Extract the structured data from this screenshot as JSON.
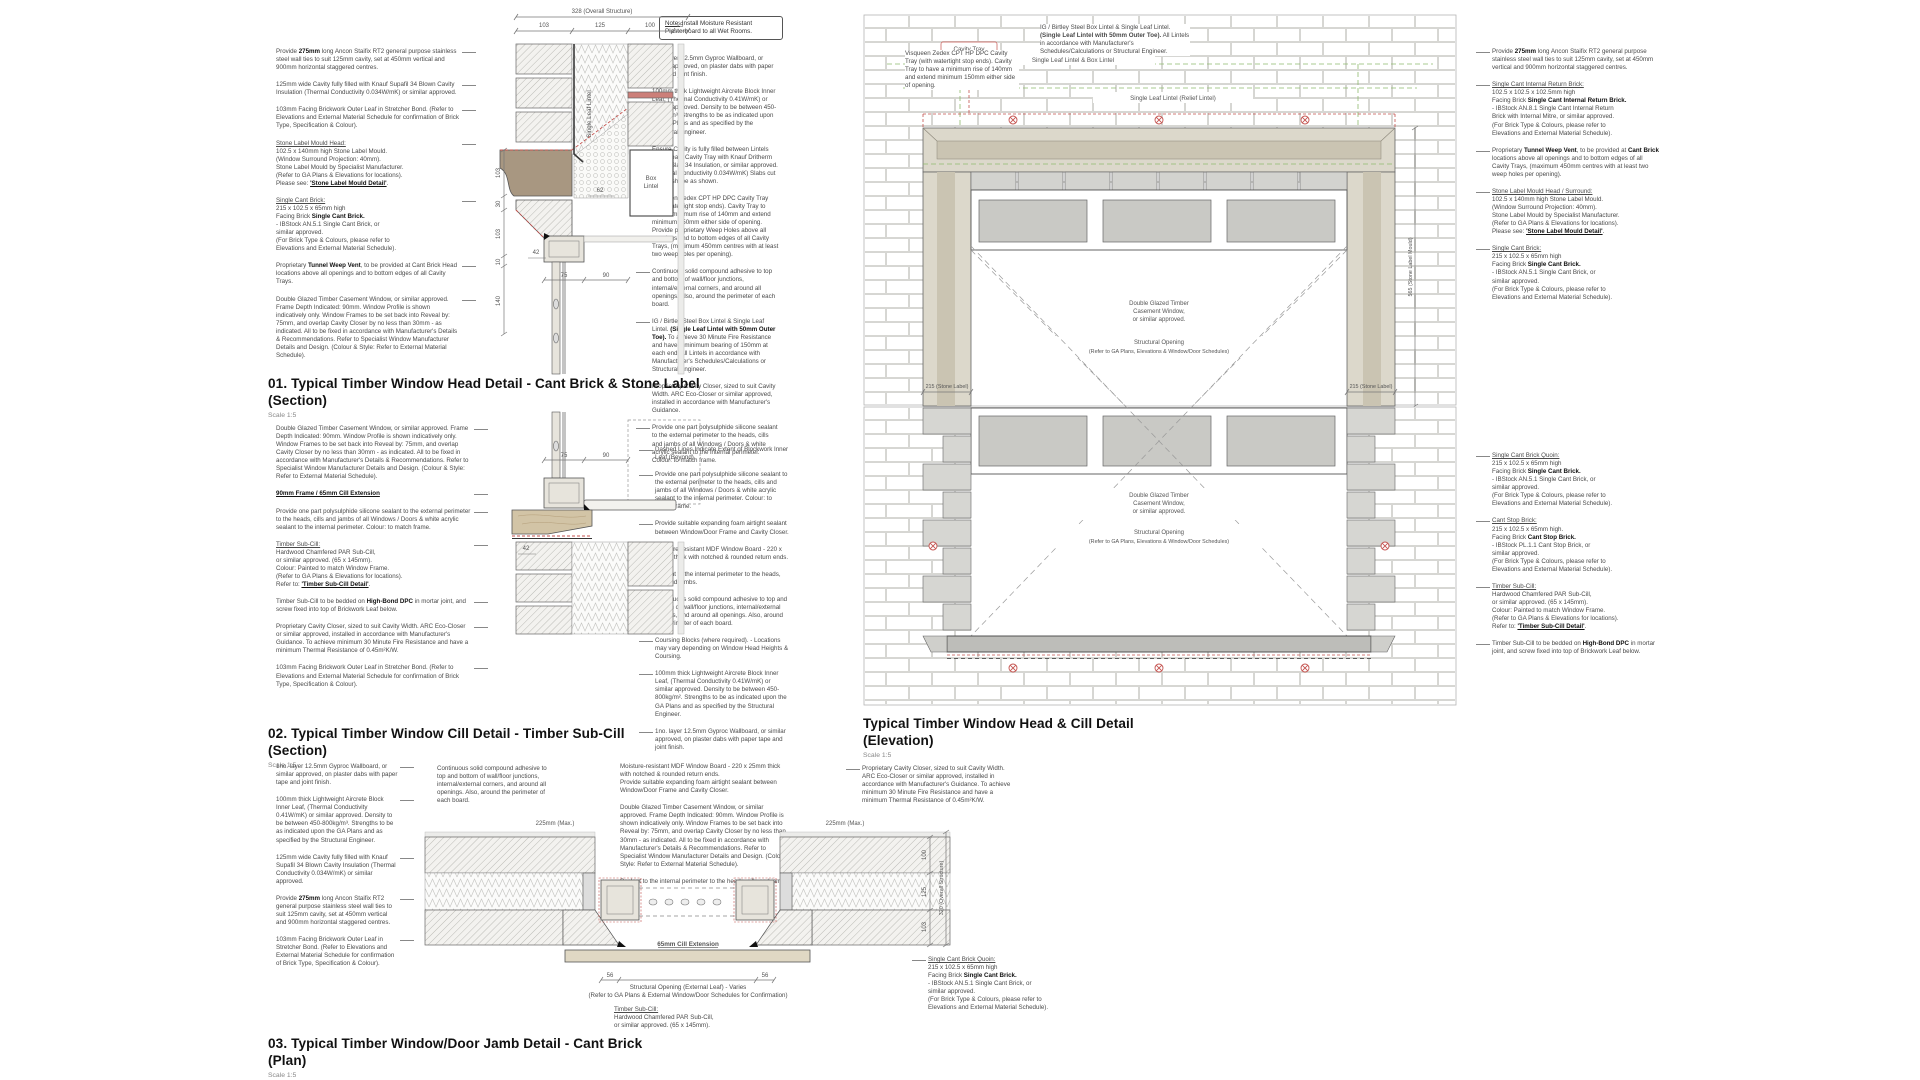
{
  "palette": {
    "green": "#8fba6e",
    "red": "#c4524e",
    "stone": "#a89781",
    "brick_joint": "#cdcdc9",
    "ink": "#444444"
  },
  "note_box": {
    "text": "__Note:__ Install Moisture Resistant Plasterboard to all Wet Rooms."
  },
  "titles": {
    "d1": {
      "line1": "01. Typical Timber Window Head Detail - Cant Brick & Stone Label",
      "line2": "(Section)",
      "scale": "Scale 1:5"
    },
    "d2": {
      "line1": "02. Typical Timber Window Cill Detail - Timber Sub-Cill",
      "line2": "(Section)",
      "scale": "Scale 1:5"
    },
    "d3": {
      "line1": "03. Typical Timber Window/Door Jamb Detail - Cant Brick",
      "line2": "(Plan)",
      "scale": "Scale 1:5"
    },
    "elev": {
      "line1": "Typical Timber Window Head & Cill Detail",
      "line2": "(Elevation)",
      "scale": "Scale 1:5"
    }
  },
  "d1": {
    "left_notes": [
      "Provide **275mm** long Ancon Staifix RT2 general purpose stainless steel wall ties to suit 125mm cavity, set at 450mm vertical and 900mm horizontal staggered centres.",
      "125mm wide Cavity fully filled with Knauf Supafil 34 Blown Cavity Insulation (Thermal Conductivity 0.034W/mK) or similar approved.",
      "103mm Facing Brickwork Outer Leaf in Stretcher Bond. (Refer to Elevations and External Material Schedule for confirmation of Brick Type, Specification & Colour).",
      "__Stone Label Mould Head:__\n102.5 x 140mm high Stone Label Mould.\n(Window Surround Projection: 40mm).\nStone Label Mould by Specialist Manufacturer.\n(Refer to GA Plans & Elevations for locations).\nPlease see: **__'Stone Label Mould Detail'__**.",
      "__Single Cant Brick:__\n215 x 102.5 x 65mm high\nFacing Brick **Single Cant Brick.**\n- IBStock AN.5.1 Single Cant Brick, or\nsimilar approved.\n(For Brick Type & Colours, please refer to\nElevations and External Material Schedule).",
      "Proprietary **Tunnel Weep Vent**, to be provided at Cant Brick Head locations above all openings and to bottom edges of all Cavity Trays.",
      "Double Glazed Timber Casement Window, or similar approved. Frame Depth Indicated: 90mm. Window Profile is shown indicatively only. Window Frames to be set back into Reveal by: 75mm, and overlap Cavity Closer by no less than 30mm - as indicated. All to be fixed in accordance with Manufacturer's Details & Recommendations. Refer to Specialist Window Manufacturer Details and Design. (Colour & Style: Refer to External Material Schedule)."
    ],
    "right_notes": [
      "1no. layer 12.5mm Gyproc Wallboard, or similar approved, on plaster dabs with paper tape and joint finish.",
      "100mm thick Lightweight Aircrete Block Inner Leaf, (Thermal Conductivity 0.41W/mK) or similar approved. Density to be between 450-800kg/m³. Strengths to be as indicated upon the GA Plans and as specified by the Structural Engineer.",
      "Ensure Cavity is fully filled between Lintels underneath Cavity Tray with Knauf Dritherm Cavity Slab 34 Insulation, or similar approved. (Thermal Conductivity 0.034W/mK) Slabs cut to size/shape as shown.",
      "Visqueen Zedex CPT HP DPC Cavity Tray (with watertight stop ends). Cavity Tray to have a minimum rise of 140mm and extend minimum 150mm either side of opening. Provide proprietary Weep Holes above all openings and to bottom edges of all Cavity Trays, (maximum 450mm centres with at least two weep holes per opening).",
      "Continuous solid compound adhesive to top and bottom of wall/floor junctions, internal/external corners, and around all openings. Also, around the perimeter of each board.",
      "IG / Birtley Steel Box Lintel & Single Leaf Lintel. **(Single Leaf Lintel with 50mm Outer Toe).** To achieve 30 Minute Fire Resistance and have a minimum bearing of 150mm at each end. All Lintels in accordance with Manufacturer's Schedules/Calculations or Structural Engineer.",
      "Proprietary Cavity Closer, sized to suit Cavity Width. ARC Eco-Closer or similar approved, installed in accordance with Manufacturer's Guidance.",
      "Provide one part polysulphide silicone sealant to the external perimeter to the heads, cills and jambs of all Windows / Doors & white acrylic sealant to the internal perimeter. Colour: to match frame."
    ],
    "dims": {
      "overall": "328 (Overall Structure)",
      "seg1": "103",
      "seg2": "125",
      "seg3": "100",
      "seg4": "25",
      "side1": "103",
      "side2": "30",
      "side3": "103",
      "side4": "10",
      "side5": "140",
      "bot1": "75",
      "bot2": "90",
      "inner1": "62",
      "inner2": "42"
    },
    "labels": {
      "single_leaf_lintel": "Single Leaf Lintel",
      "box_lintel_1": "Box",
      "box_lintel_2": "Lintel"
    }
  },
  "d2": {
    "left_notes": [
      "Double Glazed Timber Casement Window, or similar approved. Frame Depth Indicated: 90mm. Window Profile is shown indicatively only. Window Frames to be set back into Reveal by: 75mm, and overlap Cavity Closer by no less than 30mm - as indicated. All to be fixed in accordance with Manufacturer's Details & Recommendations. Refer to Specialist Window Manufacturer Details and Design. (Colour & Style: Refer to External Material Schedule).",
      "**__90mm Frame / 65mm Cill Extension__**",
      "Provide one part polysulphide silicone sealant to the external perimeter to the heads, cills and jambs of all Windows / Doors & white acrylic sealant to the internal perimeter. Colour: to match frame.",
      "__Timber Sub-Cill:__\nHardwood Chamfered PAR Sub-Cill,\nor similar approved. (65 x 145mm).\nColour: Painted to match Window Frame.\n(Refer to GA Plans & Elevations for locations).\nRefer to: **__'Timber Sub-Cill Detail'__**.",
      "Timber Sub-Cill to be bedded on **High-Bond DPC** in mortar joint, and screw fixed into top of Brickwork Leaf below.",
      "Proprietary Cavity Closer, sized to suit Cavity Width. ARC Eco-Closer or similar approved, installed in accordance with Manufacturer's Guidance. To achieve minimum 30 Minute Fire Resistance and have a minimum Thermal Resistance of 0.45m²K/W.",
      "103mm Facing Brickwork Outer Leaf in Stretcher Bond. (Refer to Elevations and External Material Schedule for confirmation of Brick Type, Specification & Colour)."
    ],
    "right_notes": [
      "Dashed Lines Indicate Extent of Blockwork Inner Leaf (Beyond).",
      "Provide one part polysulphide silicone sealant to the external perimeter to the heads, cills and jambs of all Windows / Doors & white acrylic sealant to the internal perimeter. Colour: to match frame.",
      "Provide suitable expanding foam airtight sealant between Window/Door Frame and Cavity Closer.",
      "Moisture-resistant MDF Window Board - 220 x 25mm thick with notched & rounded return ends.",
      "Sealant to the internal perimeter to the heads, cills and jambs.",
      "Continuous solid compound adhesive to top and bottom of wall/floor junctions, internal/external corners, and around all openings. Also, around the perimeter of each board.",
      "Coursing Blocks (where required). - Locations may vary depending on Window Head Heights & Coursing.",
      "100mm thick Lightweight Aircrete Block Inner Leaf, (Thermal Conductivity 0.41W/mK) or similar approved. Density to be between 450-800kg/m². Strengths to be as indicated upon the GA Plans and as specified by the Structural Engineer.",
      "1no. layer 12.5mm Gyproc Wallboard, or similar approved, on plaster dabs with paper tape and joint finish."
    ],
    "dims": {
      "d75": "75",
      "d90": "90",
      "d42": "42"
    }
  },
  "d3": {
    "left_notes": [
      "1no. layer 12.5mm Gyproc Wallboard, or similar approved, on plaster dabs with paper tape and joint finish.",
      "100mm thick Lightweight Aircrete Block Inner Leaf, (Thermal Conductivity 0.41W/mK) or similar approved. Density to be between 450-800kg/m³. Strengths to be as indicated upon the GA Plans and as specified by the Structural Engineer.",
      "125mm wide Cavity fully filled with Knauf Supafil 34 Blown Cavity Insulation (Thermal Conductivity 0.034W/mK) or similar approved.",
      "Provide **275mm** long Ancon Staifix RT2 general purpose stainless steel wall ties to suit 125mm cavity, set at 450mm vertical and 900mm horizontal staggered centres.",
      "103mm Facing Brickwork Outer Leaf in Stretcher Bond. (Refer to Elevations and External Material Schedule for confirmation of Brick Type, Specification & Colour)."
    ],
    "mid_notes": [
      "Continuous solid compound adhesive to top and bottom of wall/floor junctions, internal/external corners, and around all openings. Also, around the perimeter of each board."
    ],
    "top_notes": [
      "Moisture-resistant MDF Window Board - 220 x 25mm thick with notched & rounded return ends.\nProvide suitable expanding foam airtight sealant between Window/Door Frame and Cavity Closer.",
      "Double Glazed Timber Casement Window, or similar approved. Frame Depth Indicated: 90mm. Window Profile is shown indicatively only. Window Frames to be set back into Reveal by: 75mm, and overlap Cavity Closer by no less than 30mm - as indicated. All to be fixed in accordance with Manufacturer's Details & Recommendations. Refer to Specialist Window Manufacturer Details and Design. (Colour & Style: Refer to External Material Schedule).",
      "Sealant to the internal perimeter to the heads, cills and jambs."
    ],
    "right_notes": [
      "Proprietary Cavity Closer, sized to suit Cavity Width. ARC Eco-Closer or similar approved, installed in accordance with Manufacturer's Guidance. To achieve minimum 30 Minute Fire Resistance and have a minimum Thermal Resistance of 0.45m²K/W."
    ],
    "quoin_note": [
      "__Single Cant Brick Quoin:__\n215 x 102.5 x 65mm high\nFacing Brick **Single Cant Brick.**\n- IBStock AN.5.1 Single Cant Brick, or\nsimilar approved.\n(For Brick Type & Colours, please refer to\nElevations and External Material Schedule)."
    ],
    "cill_label": "65mm Cill Extension",
    "bottom_center": "Structural Opening (External Leaf) - Varies\n(Refer to GA Plans & External Window/Door Schedules for Confirmation)",
    "subcill_note": "__Timber Sub-Cill:__\nHardwood Chamfered PAR Sub-Cill,\nor similar approved. (65 x 145mm).",
    "dims": {
      "max_left": "225mm (Max.)",
      "max_right": "225mm (Max.)",
      "d56l": "56",
      "d56r": "56",
      "v1": "100",
      "v2": "125",
      "v3": "103",
      "overall": "320 (Overall Structure)"
    }
  },
  "elev": {
    "top_notes": {
      "visqueen": "Visqueen Zedex CPT HP DPC Cavity Tray (with watertight stop ends). Cavity Tray to have a minimum rise of 140mm and extend minimum 150mm either side of opening.",
      "lintel": "IG / Birtley Steel Box Lintel & Single Leaf Lintel. **(Single Leaf Lintel with 50mm Outer Toe).** All Lintels in accordance with Manufacturer's Schedules/Calculations or Structural Engineer."
    },
    "labels": {
      "cavity_tray": "Cavity Tray",
      "lintel_a": "Single Leaf Lintel & Box Lintel",
      "lintel_b": "Single Leaf Lintel (Relief Lintel)"
    },
    "center": {
      "l1": "Double Glazed Timber",
      "l2": "Casement Window,",
      "l3": "or similar approved.",
      "l4": "Structural Opening",
      "l5": "(Refer to GA Plans, Elevations & Window/Door Schedules)"
    },
    "dims": {
      "stone_l": "215 (Stone Label)",
      "stone_r": "215 (Stone Label)",
      "mould": "565 (Stone Label Mould)"
    },
    "right_notes_head": [
      "Provide **275mm** long Ancon Staifix RT2 general purpose stainless steel wall ties to suit 125mm cavity, set at 450mm vertical and 900mm horizontal staggered centres.",
      "__Single Cant Internal Return Brick:__\n102.5 x 102.5 x 102.5mm high\nFacing Brick **Single Cant Internal Return Brick.**\n- IBStock AN.8.1 Single Cant Internal Return\nBrick with Internal Mitre, or similar approved.\n(For Brick Type & Colours, please refer to\nElevations and External Material Schedule).",
      "Proprietary **Tunnel Weep Vent**, to be provided at **Cant Brick** locations above all openings and to bottom edges of all Cavity Trays, (maximum 450mm centres with at least two weep holes per opening).",
      "__Stone Label Mould Head / Surround:__\n102.5 x 140mm high Stone Label Mould.\n(Window Surround Projection: 40mm).\nStone Label Mould by Specialist Manufacturer.\n(Refer to GA Plans & Elevations for locations).\nPlease see: **__'Stone Label Mould Detail'__**.",
      "__Single Cant Brick:__\n215 x 102.5 x 65mm high\nFacing Brick **Single Cant Brick.**\n- IBStock AN.5.1 Single Cant Brick, or\nsimilar approved.\n(For Brick Type & Colours, please refer to\nElevations and External Material Schedule)."
    ],
    "right_notes_cill": [
      "__Single Cant Brick Quoin:__\n215 x 102.5 x 65mm high\nFacing Brick **Single Cant Brick.**\n- IBStock AN.5.1 Single Cant Brick, or\nsimilar approved.\n(For Brick Type & Colours, please refer to\nElevations and External Material Schedule).",
      "__Cant Stop Brick:__\n215 x 102.5 x 65mm high.\nFacing Brick **Cant Stop Brick.**\n- IBStock PL.1.1 Cant Stop Brick, or\nsimilar approved.\n(For Brick Type & Colours, please refer to\nElevations and External Material Schedule).",
      "__Timber Sub-Cill:__\nHardwood Chamfered PAR Sub-Cill,\nor similar approved. (65 x 145mm).\nColour: Painted to match Window Frame.\n(Refer to GA Plans & Elevations for locations).\nRefer to: **__'Timber Sub-Cill Detail'__**.",
      "Timber Sub-Cill to be bedded on **High-Bond DPC** in mortar joint, and screw fixed into top of Brickwork Leaf below."
    ]
  }
}
